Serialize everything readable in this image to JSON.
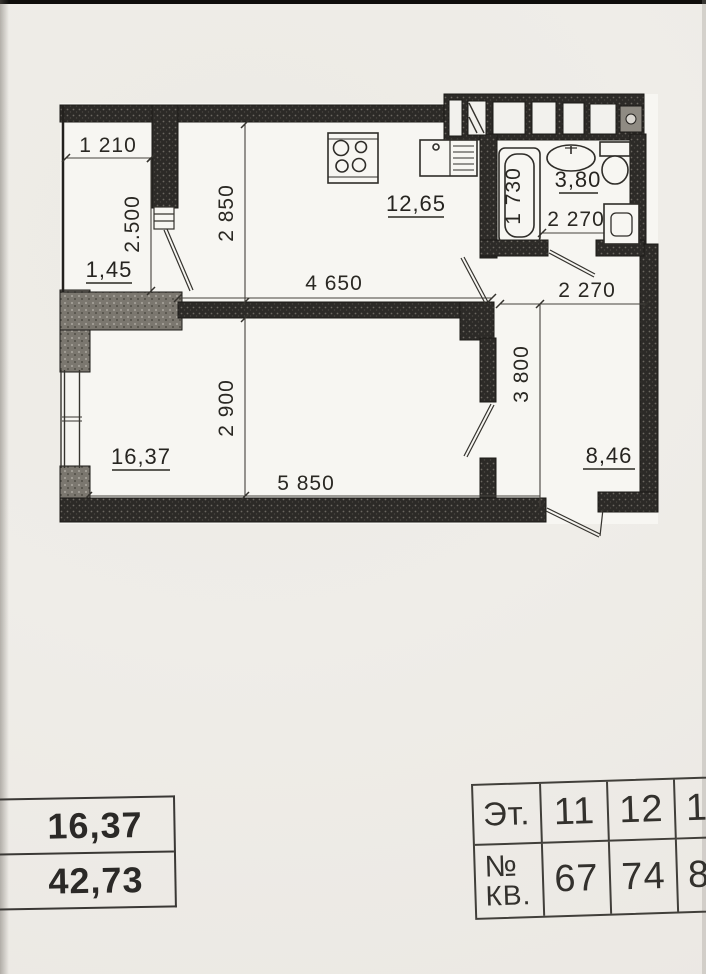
{
  "colors": {
    "paper": "#efede8",
    "ink": "#2a2823",
    "wall": "#2c2a27"
  },
  "plan": {
    "areas": {
      "loggia": "1,45",
      "kitchen": "12,65",
      "living": "16,37",
      "hall": "8,46",
      "bath": "3,80"
    },
    "dims": {
      "loggia_w": "1 210",
      "loggia_h": "2.500",
      "kitchen_h": "2 850",
      "kitchen_w": "4 650",
      "bath_tub": "1 730",
      "bath_w": "2 270",
      "hall_w": "2 270",
      "hall_h": "3 800",
      "living_h": "2 900",
      "living_w": "5 850"
    },
    "fixtures": [
      "stove",
      "kitchen-sink",
      "bathtub",
      "washbasin",
      "toilet",
      "washing-machine"
    ]
  },
  "summary_table": {
    "rows": [
      "16,37",
      "42,73"
    ]
  },
  "apartment_table": {
    "floor_label": "Эт.",
    "floors": [
      "11",
      "12",
      "1"
    ],
    "flat_label_line1": "№",
    "flat_label_line2": "КВ.",
    "flats": [
      "67",
      "74",
      "8"
    ]
  }
}
